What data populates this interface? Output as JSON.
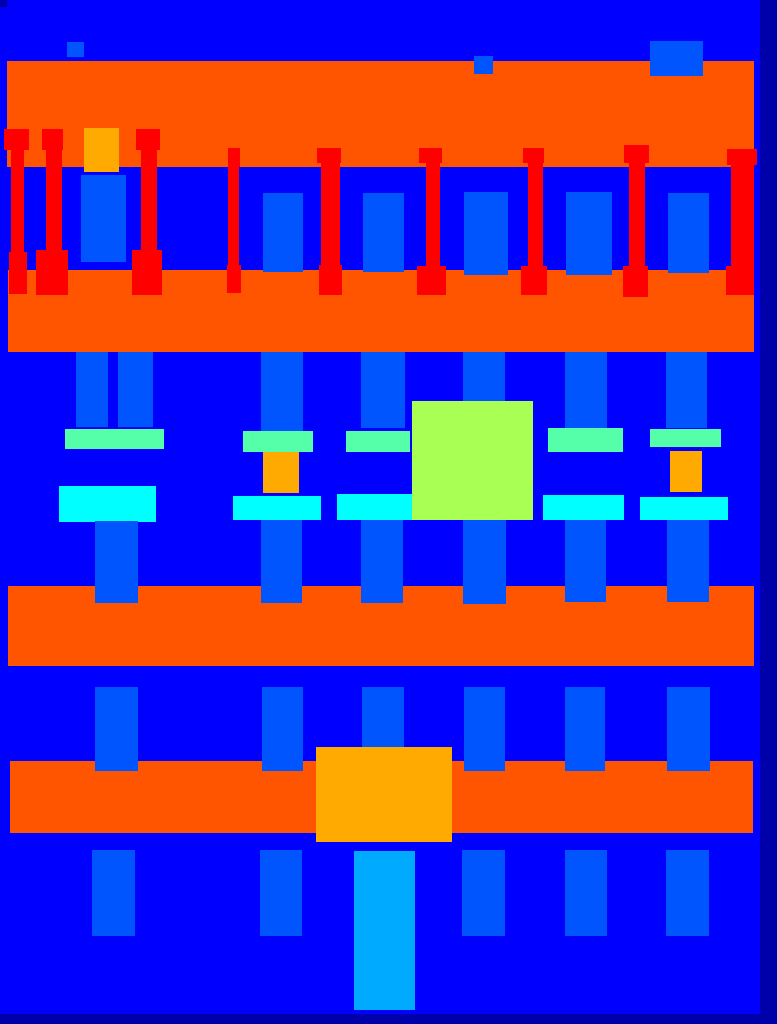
{
  "canvas": {
    "width": 777,
    "height": 1024,
    "wall_color": "#0000FF"
  },
  "palette": {
    "wall": "#0000FF",
    "background": "#0000AA",
    "window": "#0055FF",
    "door": "#00AAFF",
    "sill": "#00FFFF",
    "blind": "#55FFAA",
    "deco": "#AAFF55",
    "molding": "#FFAA00",
    "cornice": "#FF5500",
    "pillar": "#FF0000"
  },
  "rects": [
    {
      "name": "cornice-band-1",
      "class": "cornice",
      "x": 7,
      "y": 61,
      "w": 747,
      "h": 106
    },
    {
      "name": "cornice-band-2",
      "class": "cornice",
      "x": 8,
      "y": 270,
      "w": 746,
      "h": 82
    },
    {
      "name": "cornice-band-3",
      "class": "cornice",
      "x": 8,
      "y": 586,
      "w": 746,
      "h": 80
    },
    {
      "name": "cornice-band-4",
      "class": "cornice",
      "x": 10,
      "y": 761,
      "w": 743,
      "h": 72
    },
    {
      "name": "attic-window-1",
      "class": "window",
      "x": 67,
      "y": 42,
      "w": 17,
      "h": 15
    },
    {
      "name": "attic-window-2",
      "class": "window",
      "x": 474,
      "y": 56,
      "w": 19,
      "h": 18
    },
    {
      "name": "attic-window-3",
      "class": "window",
      "x": 650,
      "y": 41,
      "w": 53,
      "h": 35
    },
    {
      "name": "molding-top",
      "class": "molding",
      "x": 84,
      "y": 128,
      "w": 35,
      "h": 44
    },
    {
      "name": "f1-window-1",
      "class": "window",
      "x": 81,
      "y": 175,
      "w": 45,
      "h": 87
    },
    {
      "name": "f1-window-2",
      "class": "window",
      "x": 263,
      "y": 193,
      "w": 40,
      "h": 79
    },
    {
      "name": "f1-window-3",
      "class": "window",
      "x": 363,
      "y": 193,
      "w": 41,
      "h": 79
    },
    {
      "name": "f1-window-4",
      "class": "window",
      "x": 464,
      "y": 192,
      "w": 44,
      "h": 83
    },
    {
      "name": "f1-window-5",
      "class": "window",
      "x": 566,
      "y": 192,
      "w": 46,
      "h": 83
    },
    {
      "name": "f1-window-6",
      "class": "window",
      "x": 668,
      "y": 193,
      "w": 41,
      "h": 80
    },
    {
      "name": "pillar-1-cap",
      "class": "pillar",
      "x": 4,
      "y": 129,
      "w": 25,
      "h": 21
    },
    {
      "name": "pillar-1-stem",
      "class": "pillar",
      "x": 11,
      "y": 150,
      "w": 13,
      "h": 102
    },
    {
      "name": "pillar-1-base",
      "class": "pillar",
      "x": 9,
      "y": 252,
      "w": 18,
      "h": 42
    },
    {
      "name": "pillar-2-cap",
      "class": "pillar",
      "x": 42,
      "y": 129,
      "w": 21,
      "h": 21
    },
    {
      "name": "pillar-2-stem",
      "class": "pillar",
      "x": 46,
      "y": 150,
      "w": 16,
      "h": 100
    },
    {
      "name": "pillar-2-base",
      "class": "pillar",
      "x": 36,
      "y": 250,
      "w": 32,
      "h": 45
    },
    {
      "name": "pillar-3-cap",
      "class": "pillar",
      "x": 136,
      "y": 129,
      "w": 24,
      "h": 21
    },
    {
      "name": "pillar-3-stem",
      "class": "pillar",
      "x": 141,
      "y": 150,
      "w": 16,
      "h": 100
    },
    {
      "name": "pillar-3-base",
      "class": "pillar",
      "x": 132,
      "y": 250,
      "w": 30,
      "h": 45
    },
    {
      "name": "pillar-4-cap",
      "class": "pillar",
      "x": 228,
      "y": 148,
      "w": 12,
      "h": 19
    },
    {
      "name": "pillar-4-stem",
      "class": "pillar",
      "x": 228,
      "y": 167,
      "w": 11,
      "h": 98
    },
    {
      "name": "pillar-4-base",
      "class": "pillar",
      "x": 227,
      "y": 265,
      "w": 14,
      "h": 28
    },
    {
      "name": "pillar-5-cap",
      "class": "pillar",
      "x": 317,
      "y": 148,
      "w": 24,
      "h": 15
    },
    {
      "name": "pillar-5-stem",
      "class": "pillar",
      "x": 321,
      "y": 163,
      "w": 19,
      "h": 102
    },
    {
      "name": "pillar-5-base",
      "class": "pillar",
      "x": 319,
      "y": 265,
      "w": 23,
      "h": 30
    },
    {
      "name": "pillar-6-cap",
      "class": "pillar",
      "x": 419,
      "y": 148,
      "w": 23,
      "h": 15
    },
    {
      "name": "pillar-6-stem",
      "class": "pillar",
      "x": 426,
      "y": 163,
      "w": 14,
      "h": 103
    },
    {
      "name": "pillar-6-base",
      "class": "pillar",
      "x": 417,
      "y": 266,
      "w": 29,
      "h": 29
    },
    {
      "name": "pillar-7-cap",
      "class": "pillar",
      "x": 523,
      "y": 148,
      "w": 21,
      "h": 15
    },
    {
      "name": "pillar-7-stem",
      "class": "pillar",
      "x": 528,
      "y": 163,
      "w": 15,
      "h": 103
    },
    {
      "name": "pillar-7-base",
      "class": "pillar",
      "x": 521,
      "y": 266,
      "w": 26,
      "h": 29
    },
    {
      "name": "pillar-8-cap",
      "class": "pillar",
      "x": 624,
      "y": 145,
      "w": 25,
      "h": 18
    },
    {
      "name": "pillar-8-stem",
      "class": "pillar",
      "x": 629,
      "y": 163,
      "w": 16,
      "h": 103
    },
    {
      "name": "pillar-8-base",
      "class": "pillar",
      "x": 623,
      "y": 266,
      "w": 25,
      "h": 31
    },
    {
      "name": "pillar-9-cap",
      "class": "pillar",
      "x": 727,
      "y": 149,
      "w": 30,
      "h": 16
    },
    {
      "name": "pillar-9-stem",
      "class": "pillar",
      "x": 731,
      "y": 165,
      "w": 23,
      "h": 101
    },
    {
      "name": "pillar-9-base",
      "class": "pillar",
      "x": 726,
      "y": 266,
      "w": 28,
      "h": 29
    },
    {
      "name": "f2-window-1a",
      "class": "window",
      "x": 76,
      "y": 352,
      "w": 32,
      "h": 75
    },
    {
      "name": "f2-window-1b",
      "class": "window",
      "x": 118,
      "y": 352,
      "w": 35,
      "h": 75
    },
    {
      "name": "f2-window-2",
      "class": "window",
      "x": 261,
      "y": 352,
      "w": 42,
      "h": 80
    },
    {
      "name": "f2-window-3",
      "class": "window",
      "x": 361,
      "y": 352,
      "w": 44,
      "h": 76
    },
    {
      "name": "f2-window-4",
      "class": "window",
      "x": 463,
      "y": 352,
      "w": 42,
      "h": 76
    },
    {
      "name": "f2-window-5",
      "class": "window",
      "x": 565,
      "y": 352,
      "w": 42,
      "h": 76
    },
    {
      "name": "f2-window-6",
      "class": "window",
      "x": 666,
      "y": 352,
      "w": 41,
      "h": 76
    },
    {
      "name": "blind-1",
      "class": "blind",
      "x": 65,
      "y": 429,
      "w": 99,
      "h": 20
    },
    {
      "name": "blind-2",
      "class": "blind",
      "x": 243,
      "y": 431,
      "w": 70,
      "h": 21
    },
    {
      "name": "blind-3",
      "class": "blind",
      "x": 346,
      "y": 431,
      "w": 64,
      "h": 21
    },
    {
      "name": "blind-4",
      "class": "blind",
      "x": 548,
      "y": 428,
      "w": 75,
      "h": 24
    },
    {
      "name": "blind-5",
      "class": "blind",
      "x": 650,
      "y": 429,
      "w": 71,
      "h": 18
    },
    {
      "name": "molding-mid-1",
      "class": "molding",
      "x": 263,
      "y": 452,
      "w": 36,
      "h": 41
    },
    {
      "name": "molding-mid-2",
      "class": "molding",
      "x": 670,
      "y": 451,
      "w": 32,
      "h": 41
    },
    {
      "name": "sill-1",
      "class": "sill",
      "x": 59,
      "y": 486,
      "w": 97,
      "h": 36
    },
    {
      "name": "sill-2",
      "class": "sill",
      "x": 233,
      "y": 496,
      "w": 88,
      "h": 24
    },
    {
      "name": "sill-3",
      "class": "sill",
      "x": 337,
      "y": 494,
      "w": 75,
      "h": 26
    },
    {
      "name": "sill-4",
      "class": "sill",
      "x": 543,
      "y": 495,
      "w": 81,
      "h": 25
    },
    {
      "name": "sill-5",
      "class": "sill",
      "x": 640,
      "y": 497,
      "w": 88,
      "h": 23
    },
    {
      "name": "deco-square",
      "class": "deco",
      "x": 412,
      "y": 401,
      "w": 121,
      "h": 119
    },
    {
      "name": "f2-pier-1",
      "class": "window",
      "x": 95,
      "y": 521,
      "w": 43,
      "h": 82
    },
    {
      "name": "f2-pier-2",
      "class": "window",
      "x": 261,
      "y": 520,
      "w": 41,
      "h": 83
    },
    {
      "name": "f2-pier-3",
      "class": "window",
      "x": 361,
      "y": 520,
      "w": 42,
      "h": 83
    },
    {
      "name": "f2-pier-4",
      "class": "window",
      "x": 463,
      "y": 520,
      "w": 43,
      "h": 84
    },
    {
      "name": "f2-pier-5",
      "class": "window",
      "x": 565,
      "y": 520,
      "w": 41,
      "h": 82
    },
    {
      "name": "f2-pier-6",
      "class": "window",
      "x": 667,
      "y": 520,
      "w": 42,
      "h": 82
    },
    {
      "name": "f3-window-1",
      "class": "window",
      "x": 95,
      "y": 687,
      "w": 43,
      "h": 84
    },
    {
      "name": "f3-window-2",
      "class": "window",
      "x": 262,
      "y": 687,
      "w": 41,
      "h": 84
    },
    {
      "name": "f3-window-3",
      "class": "window",
      "x": 362,
      "y": 687,
      "w": 42,
      "h": 84
    },
    {
      "name": "f3-window-4",
      "class": "window",
      "x": 464,
      "y": 687,
      "w": 41,
      "h": 84
    },
    {
      "name": "f3-window-5",
      "class": "window",
      "x": 565,
      "y": 687,
      "w": 40,
      "h": 84
    },
    {
      "name": "f3-window-6",
      "class": "window",
      "x": 667,
      "y": 687,
      "w": 43,
      "h": 84
    },
    {
      "name": "molding-large",
      "class": "molding",
      "x": 316,
      "y": 747,
      "w": 136,
      "h": 95
    },
    {
      "name": "f4-window-1",
      "class": "window",
      "x": 92,
      "y": 850,
      "w": 43,
      "h": 86
    },
    {
      "name": "f4-window-2",
      "class": "window",
      "x": 260,
      "y": 850,
      "w": 42,
      "h": 86
    },
    {
      "name": "f4-window-3",
      "class": "window",
      "x": 462,
      "y": 850,
      "w": 43,
      "h": 86
    },
    {
      "name": "f4-window-4",
      "class": "window",
      "x": 565,
      "y": 850,
      "w": 42,
      "h": 86
    },
    {
      "name": "f4-window-5",
      "class": "window",
      "x": 666,
      "y": 850,
      "w": 43,
      "h": 86
    },
    {
      "name": "door",
      "class": "door",
      "x": 354,
      "y": 851,
      "w": 61,
      "h": 159
    },
    {
      "name": "background-corner-patch",
      "class": "background",
      "x": 0,
      "y": 0,
      "w": 7,
      "h": 7
    },
    {
      "name": "background-right-strip",
      "class": "background",
      "x": 760,
      "y": 0,
      "w": 17,
      "h": 1024
    },
    {
      "name": "background-bottom-band",
      "class": "background",
      "x": 0,
      "y": 1014,
      "w": 777,
      "h": 10
    }
  ]
}
